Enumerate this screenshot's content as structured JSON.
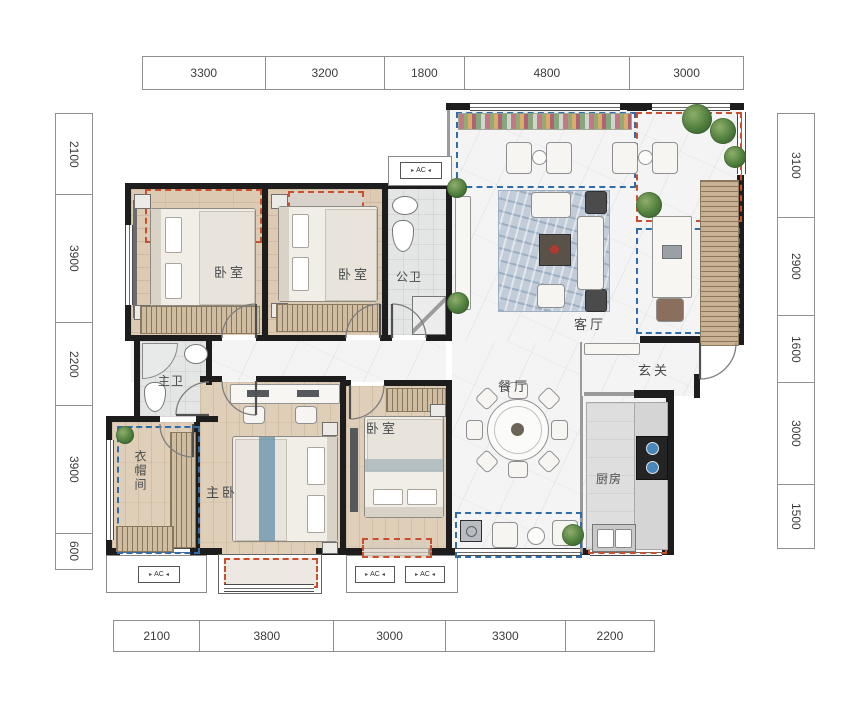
{
  "plan": {
    "title": "floor-plan",
    "rooms": {
      "bedroom_top_left": "卧室",
      "bedroom_top_mid": "卧室",
      "bath_public": "公卫",
      "living": "客厅",
      "foyer": "玄关",
      "dining": "餐厅",
      "bath_master": "主卫",
      "cloakroom": "衣帽间",
      "bedroom_master": "主卧",
      "bedroom_bottom": "卧室",
      "kitchen": "厨房"
    },
    "ac_label": "AC",
    "ac_tri_left": "▸",
    "ac_tri_right": "◂"
  },
  "dimensions": {
    "top": [
      "3300",
      "3200",
      "1800",
      "4800",
      "3000"
    ],
    "bottom": [
      "2100",
      "3800",
      "3000",
      "3300",
      "2200"
    ],
    "left": [
      "2100",
      "3900",
      "2200",
      "3900",
      "600"
    ],
    "right": [
      "3100",
      "2900",
      "1600",
      "3000",
      "1500"
    ]
  },
  "colors": {
    "wall": "#1d1d1d",
    "gift_area_dash": "#c8502f",
    "balcony_area_dash": "#2e6cab",
    "wood_floor": "#dccab3",
    "marble_floor": "#f4f4f5",
    "plant_green": "#4e7d3c"
  }
}
